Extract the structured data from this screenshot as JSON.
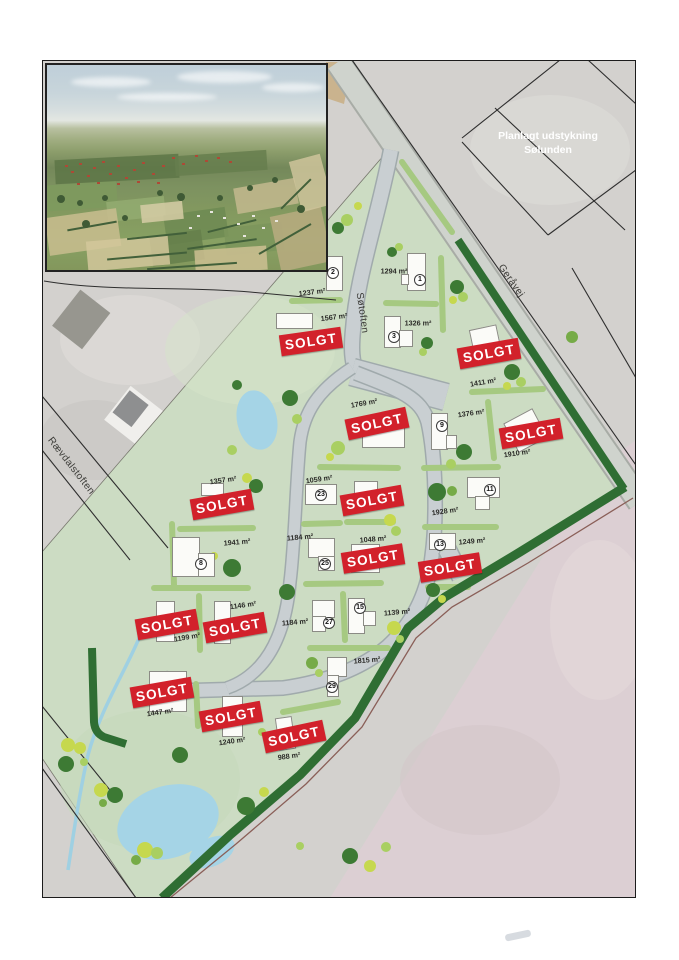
{
  "colors": {
    "sold_red": "#d2212b",
    "development_green": "#ccdcc3",
    "hedge_dark_green": "#2f6e33",
    "hedge_light_green": "#a6c981",
    "road_gray": "#c9cfd2",
    "water_blue": "#a5d4e6",
    "field_pink": "#dccfd3",
    "aerial_gray": "#d3d1ce"
  },
  "overlay_title": {
    "line1": "Planlagt udstykning",
    "line2": "Sølunden"
  },
  "sold_banner_text": "SOLGT",
  "streets": [
    {
      "id": "sotoften",
      "name": "Søtoften",
      "x": 362,
      "y": 313,
      "rot": 82
    },
    {
      "id": "geravej",
      "name": "Geråvej",
      "x": 511,
      "y": 281,
      "rot": 55
    },
    {
      "id": "raevdalstoften",
      "name": "Rævdalstoften",
      "x": 71,
      "y": 466,
      "rot": 52
    }
  ],
  "lots": [
    {
      "id": "lot-2",
      "number": "2",
      "area": "1237 m²",
      "sold": false,
      "label": {
        "x": 312,
        "y": 292,
        "rot": -7
      },
      "circle": {
        "x": 333,
        "y": 273
      },
      "houses": [
        {
          "x": 326,
          "y": 256,
          "w": 17,
          "h": 35,
          "rot": 0
        }
      ]
    },
    {
      "id": "lot-1",
      "number": "1",
      "area": "1294 m²",
      "sold": false,
      "label": {
        "x": 394,
        "y": 271,
        "rot": 0
      },
      "circle": {
        "x": 420,
        "y": 280
      },
      "houses": [
        {
          "x": 407,
          "y": 253,
          "w": 19,
          "h": 38,
          "rot": 0
        },
        {
          "x": 401,
          "y": 274,
          "w": 8,
          "h": 11,
          "rot": 0
        }
      ]
    },
    {
      "id": "lot-3",
      "number": "3",
      "area": "1326 m²",
      "sold": false,
      "label": {
        "x": 418,
        "y": 323,
        "rot": 0
      },
      "circle": {
        "x": 394,
        "y": 337
      },
      "houses": [
        {
          "x": 384,
          "y": 316,
          "w": 17,
          "h": 32,
          "rot": 0
        },
        {
          "x": 399,
          "y": 330,
          "w": 14,
          "h": 17,
          "rot": 0
        }
      ]
    },
    {
      "id": "lot-1567",
      "number": null,
      "area": "1567 m²",
      "sold": true,
      "label": {
        "x": 334,
        "y": 317,
        "rot": -7
      },
      "banner": {
        "x": 311,
        "y": 341,
        "rot": -8
      },
      "houses": [
        {
          "x": 276,
          "y": 313,
          "w": 37,
          "h": 16,
          "rot": 0
        }
      ]
    },
    {
      "id": "lot-1411",
      "number": null,
      "area": "1411 m²",
      "sold": true,
      "label": {
        "x": 483,
        "y": 382,
        "rot": -10
      },
      "banner": {
        "x": 489,
        "y": 353,
        "rot": -10
      },
      "houses": [
        {
          "x": 471,
          "y": 327,
          "w": 28,
          "h": 24,
          "rot": -12
        }
      ]
    },
    {
      "id": "lot-1769",
      "number": null,
      "area": "1769 m²",
      "sold": true,
      "label": {
        "x": 364,
        "y": 403,
        "rot": -10
      },
      "banner": {
        "x": 377,
        "y": 423,
        "rot": -12
      },
      "houses": [
        {
          "x": 362,
          "y": 427,
          "w": 43,
          "h": 21,
          "rot": 0
        }
      ]
    },
    {
      "id": "lot-9",
      "number": "9",
      "area": "1376 m²",
      "sold": false,
      "label": {
        "x": 471,
        "y": 413,
        "rot": -8
      },
      "circle": {
        "x": 442,
        "y": 426
      },
      "houses": [
        {
          "x": 431,
          "y": 413,
          "w": 17,
          "h": 37,
          "rot": 0
        },
        {
          "x": 446,
          "y": 435,
          "w": 11,
          "h": 14,
          "rot": 0
        }
      ]
    },
    {
      "id": "lot-1910",
      "number": null,
      "area": "1910 m²",
      "sold": true,
      "label": {
        "x": 517,
        "y": 453,
        "rot": -8
      },
      "banner": {
        "x": 531,
        "y": 433,
        "rot": -10
      },
      "houses": [
        {
          "x": 509,
          "y": 414,
          "w": 33,
          "h": 33,
          "rot": -28
        }
      ]
    },
    {
      "id": "lot-1357",
      "number": null,
      "area": "1357 m²",
      "sold": true,
      "label": {
        "x": 223,
        "y": 480,
        "rot": -8
      },
      "banner": {
        "x": 222,
        "y": 504,
        "rot": -10
      },
      "houses": [
        {
          "x": 201,
          "y": 483,
          "w": 23,
          "h": 13,
          "rot": 0
        }
      ]
    },
    {
      "id": "lot-23",
      "number": "23",
      "area": "1059 m²",
      "sold": false,
      "label": {
        "x": 319,
        "y": 479,
        "rot": -8
      },
      "circle": {
        "x": 321,
        "y": 495
      },
      "houses": [
        {
          "x": 305,
          "y": 484,
          "w": 32,
          "h": 21,
          "rot": 0
        }
      ]
    },
    {
      "id": "lot-mid-sold",
      "number": null,
      "area": null,
      "sold": true,
      "banner": {
        "x": 372,
        "y": 500,
        "rot": -10
      },
      "houses": [
        {
          "x": 354,
          "y": 481,
          "w": 24,
          "h": 15,
          "rot": 0
        }
      ]
    },
    {
      "id": "lot-11",
      "number": "11",
      "area": "1928 m²",
      "sold": false,
      "label": {
        "x": 445,
        "y": 511,
        "rot": -8
      },
      "circle": {
        "x": 490,
        "y": 490
      },
      "houses": [
        {
          "x": 467,
          "y": 477,
          "w": 33,
          "h": 21,
          "rot": 0
        },
        {
          "x": 475,
          "y": 496,
          "w": 15,
          "h": 14,
          "rot": 0
        }
      ]
    },
    {
      "id": "lot-8",
      "number": "8",
      "area": "1941 m²",
      "sold": false,
      "label": {
        "x": 237,
        "y": 542,
        "rot": -5
      },
      "circle": {
        "x": 201,
        "y": 564
      },
      "houses": [
        {
          "x": 172,
          "y": 537,
          "w": 28,
          "h": 40,
          "rot": 0
        },
        {
          "x": 198,
          "y": 553,
          "w": 17,
          "h": 24,
          "rot": 0
        }
      ]
    },
    {
      "id": "lot-25",
      "number": "25",
      "area": "1184 m²",
      "sold": false,
      "label": {
        "x": 300,
        "y": 537,
        "rot": -5
      },
      "circle": {
        "x": 325,
        "y": 564
      },
      "houses": [
        {
          "x": 308,
          "y": 538,
          "w": 27,
          "h": 20,
          "rot": 0
        },
        {
          "x": 318,
          "y": 556,
          "w": 17,
          "h": 15,
          "rot": 0
        }
      ]
    },
    {
      "id": "lot-1048",
      "number": null,
      "area": "1048 m²",
      "sold": true,
      "label": {
        "x": 373,
        "y": 539,
        "rot": -5
      },
      "banner": {
        "x": 373,
        "y": 558,
        "rot": -9
      },
      "houses": [
        {
          "x": 351,
          "y": 544,
          "w": 29,
          "h": 29,
          "rot": 0
        }
      ]
    },
    {
      "id": "lot-13",
      "number": "13",
      "area": "1249 m²",
      "sold": false,
      "label": {
        "x": 472,
        "y": 541,
        "rot": -5
      },
      "circle": {
        "x": 440,
        "y": 545
      },
      "houses": [
        {
          "x": 429,
          "y": 533,
          "w": 27,
          "h": 17,
          "rot": 0
        }
      ]
    },
    {
      "id": "lot-se-sold",
      "number": null,
      "area": null,
      "sold": true,
      "banner": {
        "x": 450,
        "y": 567,
        "rot": -9
      },
      "houses": []
    },
    {
      "id": "lot-1199",
      "number": null,
      "area": "1199 m²",
      "sold": true,
      "label": {
        "x": 187,
        "y": 637,
        "rot": -10
      },
      "banner": {
        "x": 167,
        "y": 624,
        "rot": -10
      },
      "houses": [
        {
          "x": 156,
          "y": 601,
          "w": 19,
          "h": 41,
          "rot": 0
        }
      ]
    },
    {
      "id": "lot-1146",
      "number": null,
      "area": "1146 m²",
      "sold": true,
      "label": {
        "x": 243,
        "y": 605,
        "rot": -8
      },
      "banner": {
        "x": 235,
        "y": 627,
        "rot": -10
      },
      "houses": [
        {
          "x": 214,
          "y": 601,
          "w": 17,
          "h": 43,
          "rot": 0
        }
      ]
    },
    {
      "id": "lot-27",
      "number": "27",
      "area": "1184 m²",
      "sold": false,
      "label": {
        "x": 295,
        "y": 622,
        "rot": -5
      },
      "circle": {
        "x": 329,
        "y": 623
      },
      "houses": [
        {
          "x": 312,
          "y": 600,
          "w": 23,
          "h": 18,
          "rot": 0
        },
        {
          "x": 312,
          "y": 616,
          "w": 14,
          "h": 16,
          "rot": 0
        }
      ]
    },
    {
      "id": "lot-15",
      "number": "15",
      "area": "1139 m²",
      "sold": false,
      "label": {
        "x": 397,
        "y": 612,
        "rot": -5
      },
      "circle": {
        "x": 360,
        "y": 608
      },
      "houses": [
        {
          "x": 348,
          "y": 598,
          "w": 17,
          "h": 36,
          "rot": 0
        },
        {
          "x": 363,
          "y": 611,
          "w": 13,
          "h": 15,
          "rot": 0
        }
      ]
    },
    {
      "id": "lot-29",
      "number": "29",
      "area": "1815 m²",
      "sold": false,
      "label": {
        "x": 367,
        "y": 660,
        "rot": -5
      },
      "circle": {
        "x": 332,
        "y": 687
      },
      "houses": [
        {
          "x": 327,
          "y": 657,
          "w": 20,
          "h": 20,
          "rot": 0
        },
        {
          "x": 327,
          "y": 675,
          "w": 12,
          "h": 22,
          "rot": 0
        }
      ]
    },
    {
      "id": "lot-1447",
      "number": null,
      "area": "1447 m²",
      "sold": true,
      "label": {
        "x": 160,
        "y": 712,
        "rot": -8
      },
      "banner": {
        "x": 162,
        "y": 692,
        "rot": -10
      },
      "houses": [
        {
          "x": 149,
          "y": 671,
          "w": 38,
          "h": 41,
          "rot": 0
        }
      ]
    },
    {
      "id": "lot-1240",
      "number": null,
      "area": "1240 m²",
      "sold": true,
      "label": {
        "x": 232,
        "y": 741,
        "rot": -8
      },
      "banner": {
        "x": 231,
        "y": 716,
        "rot": -10
      },
      "houses": [
        {
          "x": 222,
          "y": 696,
          "w": 21,
          "h": 41,
          "rot": 0
        }
      ]
    },
    {
      "id": "lot-988",
      "number": null,
      "area": "988 m²",
      "sold": true,
      "label": {
        "x": 289,
        "y": 756,
        "rot": -8
      },
      "banner": {
        "x": 294,
        "y": 736,
        "rot": -12
      },
      "houses": [
        {
          "x": 277,
          "y": 717,
          "w": 17,
          "h": 33,
          "rot": -8
        }
      ]
    }
  ]
}
